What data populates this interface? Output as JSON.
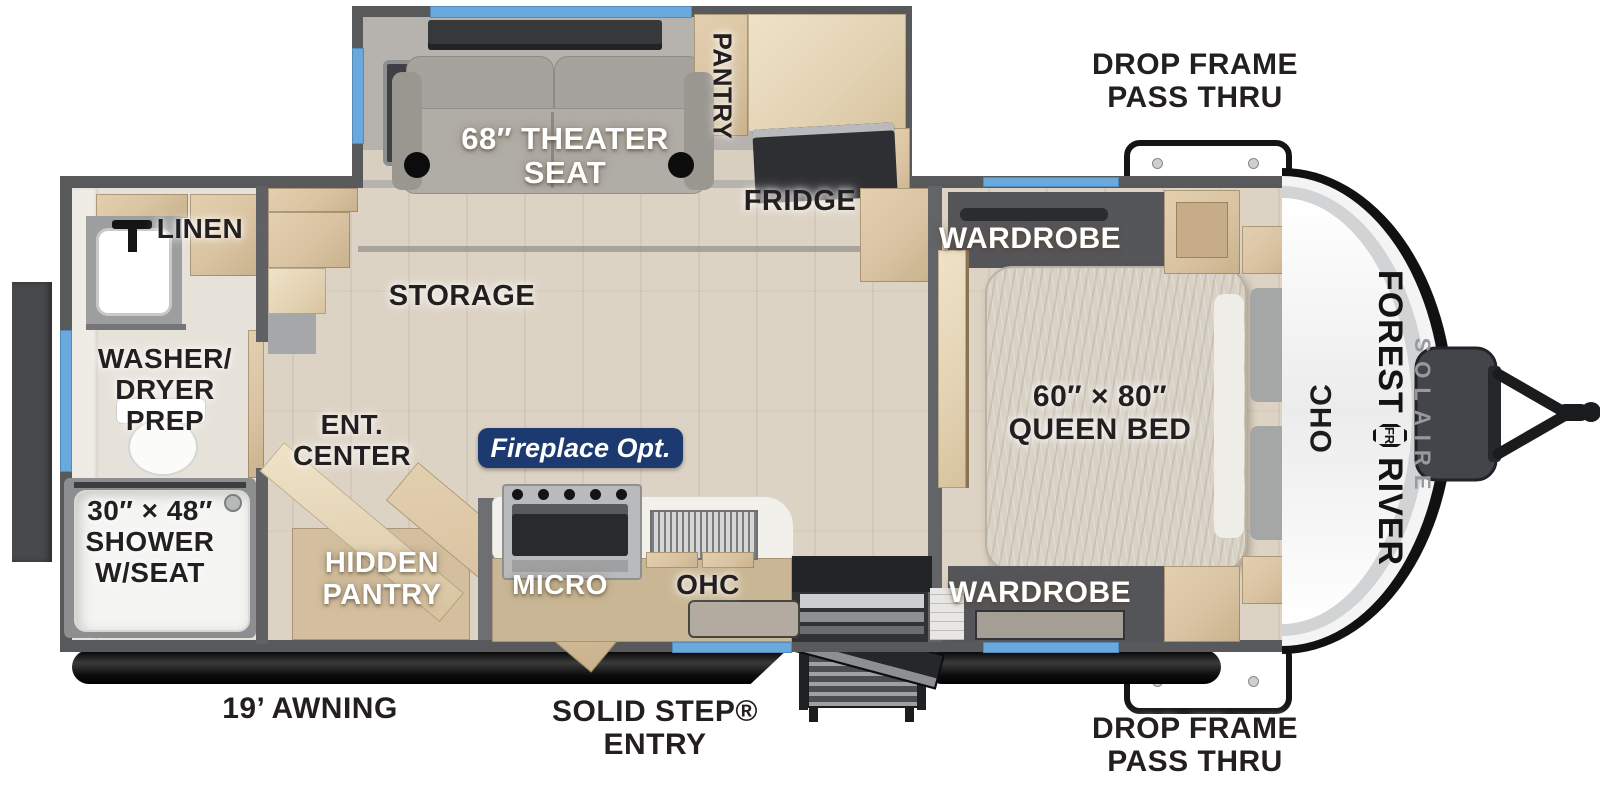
{
  "title": "Forest River Solaire travel trailer floorplan",
  "exterior": {
    "drop_frame_top": "DROP FRAME\nPASS THRU",
    "drop_frame_bottom": "DROP FRAME\nPASS THRU",
    "awning": "19’ AWNING",
    "entry": "SOLID STEP®\nENTRY"
  },
  "living": {
    "theater_seat": "68″ THEATER\nSEAT",
    "pantry": "PANTRY",
    "fridge": "FRIDGE",
    "storage": "STORAGE",
    "ent_center": "ENT.\nCENTER",
    "fireplace": "Fireplace Opt.",
    "hidden_pantry": "HIDDEN\nPANTRY",
    "micro": "MICRO",
    "ohc": "OHC"
  },
  "bath": {
    "linen": "LINEN",
    "washer_dryer": "WASHER/\nDRYER\nPREP",
    "shower": "30″ × 48″\nSHOWER\nW/SEAT"
  },
  "bedroom": {
    "wardrobe_top": "WARDROBE",
    "wardrobe_bottom": "WARDROBE",
    "queen_bed": "60″ × 80″\nQUEEN BED"
  },
  "front_cap": {
    "ohc": "OHC",
    "brand_forest": "FOREST",
    "brand_river": "RIVER",
    "brand_sub": "SOLAIRE",
    "emblem": "FR"
  },
  "colors": {
    "accent_blue": "#6aa9de",
    "badge_navy": "#1d3a70",
    "wall_gray": "#58595b",
    "floor_wood": "#ddd3c4",
    "cabinet_wood": "#d9c3a2",
    "carpet_gray": "#b6b2ad",
    "label_black": "#231f20"
  }
}
